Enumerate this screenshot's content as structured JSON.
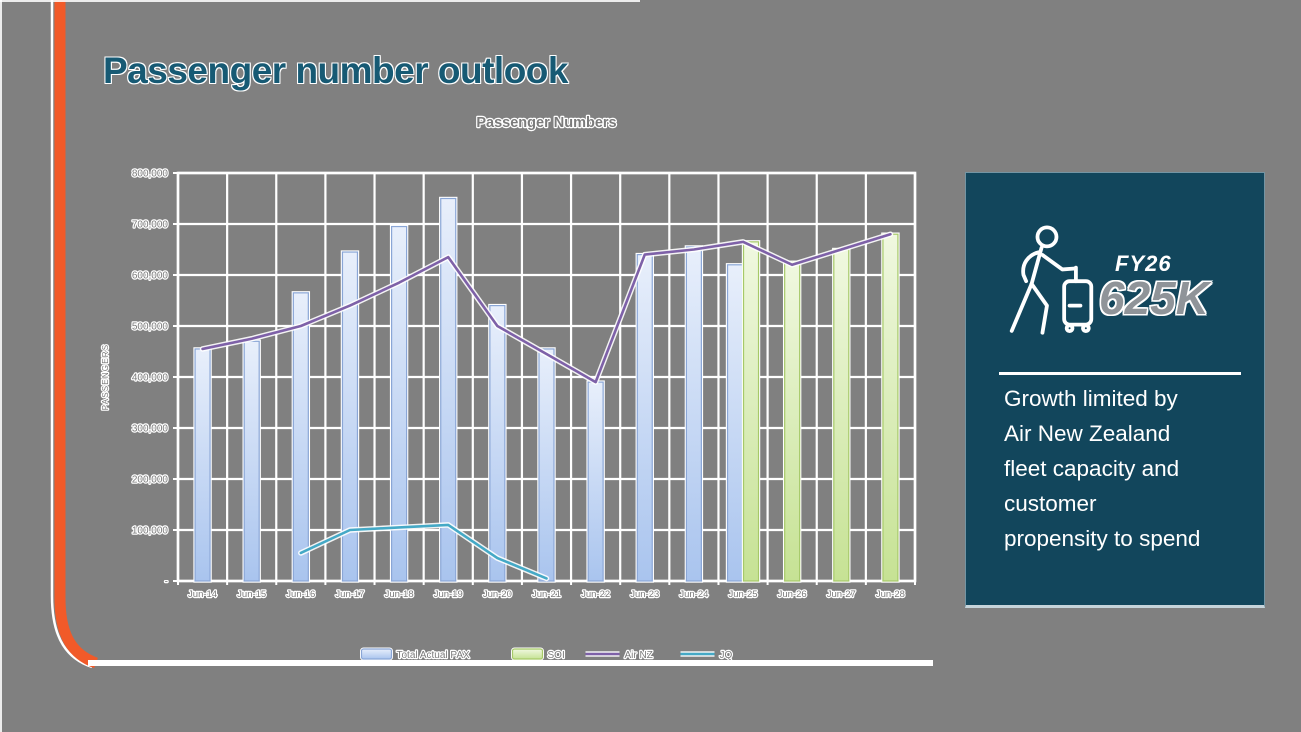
{
  "slide": {
    "title": "Passenger number outlook",
    "background_color": "#808080",
    "accent_color": "#f15a29",
    "title_color": "#175a74"
  },
  "chart_data": {
    "type": "bar",
    "subtype": "combo-bar-line",
    "title": "Passenger Numbers",
    "ylabel": "PASSENGERS",
    "xlabel": "",
    "ylim": [
      0,
      800000
    ],
    "ytick_step": 100000,
    "zero_tick_label": "-",
    "grid": "both",
    "grid_color": "#ffffff",
    "legend_position": "bottom",
    "categories": [
      "Jun-14",
      "Jun-15",
      "Jun-16",
      "Jun-17",
      "Jun-18",
      "Jun-19",
      "Jun-20",
      "Jun-21",
      "Jun-22",
      "Jun-23",
      "Jun-24",
      "Jun-25",
      "Jun-26",
      "Jun-27",
      "Jun-28"
    ],
    "series": [
      {
        "name": "Total Actual PAX",
        "type": "bar",
        "fill_top": "#e8effb",
        "fill_bottom": "#a9c4ee",
        "border": "#8aa6d6",
        "values": [
          455000,
          470000,
          565000,
          645000,
          695000,
          750000,
          540000,
          455000,
          390000,
          640000,
          655000,
          620000,
          null,
          null,
          null
        ]
      },
      {
        "name": "SOI",
        "type": "bar",
        "fill_top": "#f0f8e0",
        "fill_bottom": "#c6e294",
        "border": "#a6c968",
        "values": [
          null,
          null,
          null,
          null,
          null,
          null,
          null,
          null,
          null,
          null,
          null,
          665000,
          625000,
          650000,
          680000
        ]
      },
      {
        "name": "Air NZ",
        "type": "line",
        "color": "#7e61a8",
        "values": [
          455000,
          475000,
          500000,
          540000,
          585000,
          635000,
          500000,
          445000,
          390000,
          640000,
          650000,
          665000,
          620000,
          650000,
          680000
        ]
      },
      {
        "name": "JQ",
        "type": "line",
        "color": "#45a9c6",
        "values": [
          null,
          null,
          55000,
          100000,
          105000,
          110000,
          45000,
          5000,
          null,
          null,
          null,
          null,
          null,
          null,
          null
        ]
      }
    ]
  },
  "callout": {
    "panel_color": "#12465c",
    "icon": "traveler-with-suitcase-icon",
    "fy_label": "FY26",
    "fy_value": "625K",
    "description_lines": [
      "Growth limited by",
      "Air New Zealand",
      "fleet capacity and",
      "customer",
      "propensity to spend"
    ]
  }
}
